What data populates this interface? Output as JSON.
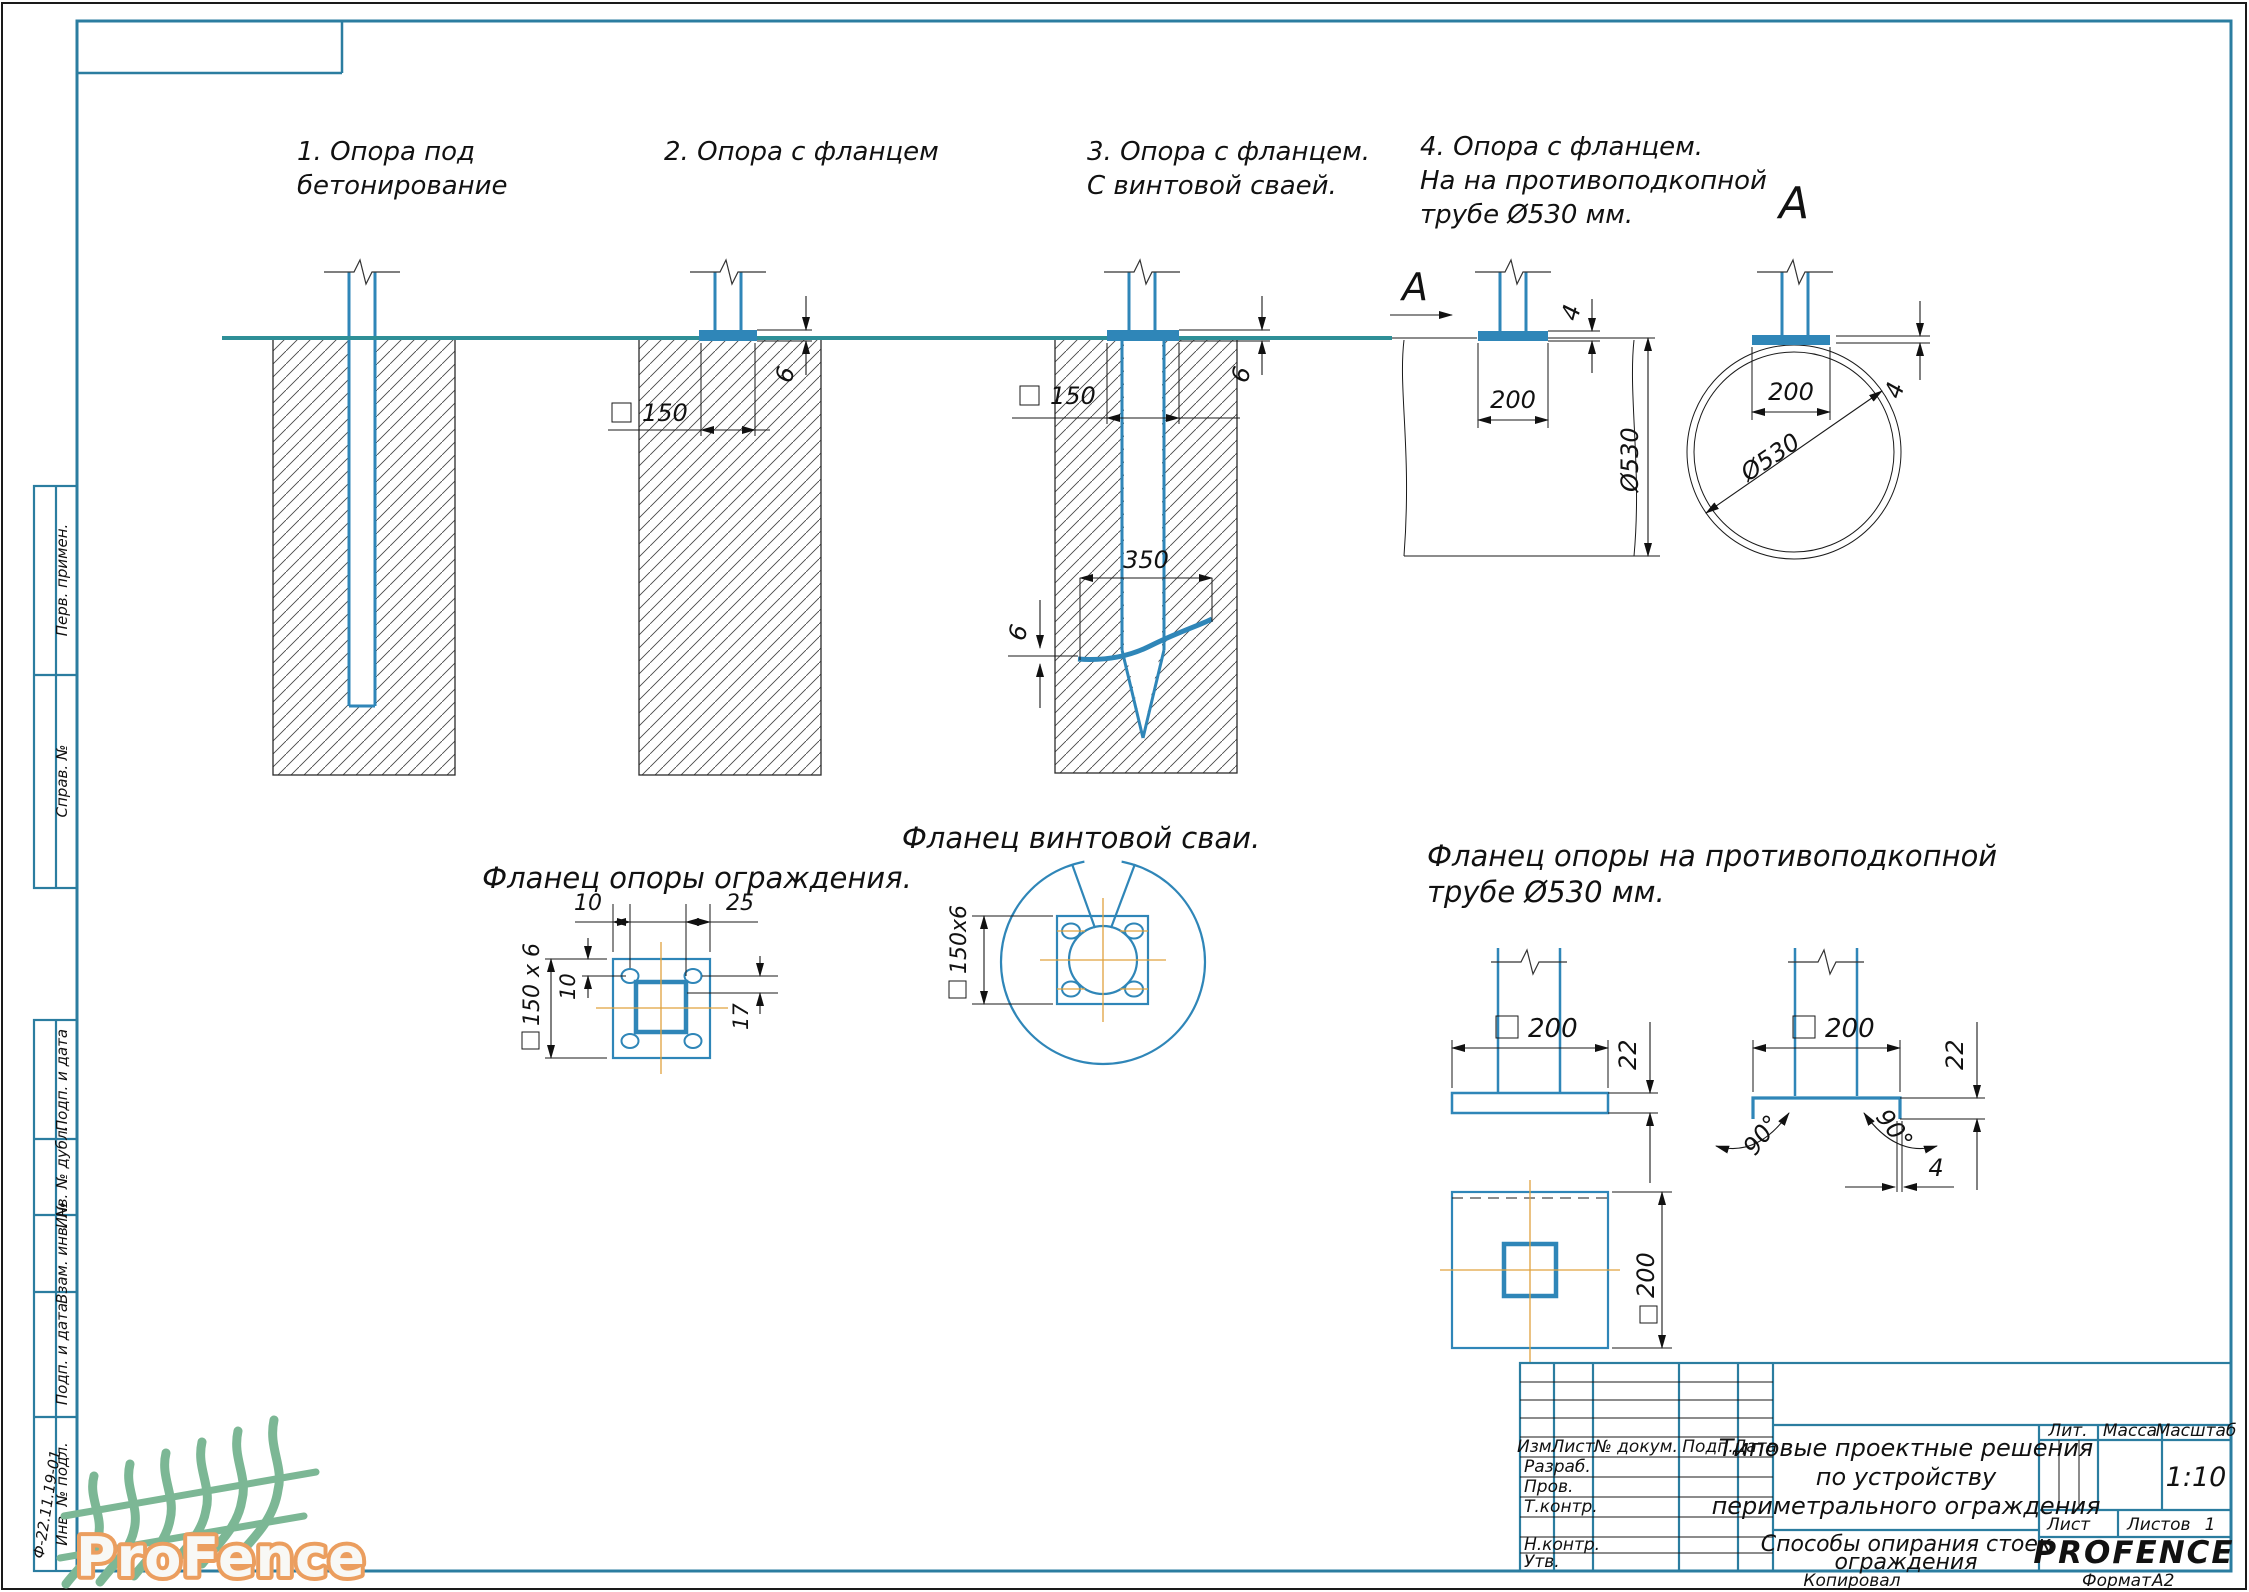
{
  "labels": {
    "o1l1": "1. Опора под",
    "o1l2": "бетонирование",
    "o2": "2. Опора с фланцем",
    "o3l1": "3. Опора с фланцем.",
    "o3l2": "С винтовой сваей.",
    "o4l1": "4. Опора с фланцем.",
    "o4l2": "На на противоподкопной",
    "o4l3": "трубе Ø530 мм.",
    "section_arrow": "A",
    "section_view": "A",
    "f1": "Фланец опоры ограждения.",
    "f2": "Фланец винтовой сваи.",
    "f3l1": "Фланец опоры на противоподкопной",
    "f3l2": "трубе Ø530 мм."
  },
  "dims": {
    "v6": "6",
    "v4": "4",
    "v10": "10",
    "v17": "17",
    "v22": "22",
    "v25": "25",
    "v150": "150",
    "v200": "200",
    "v350": "350",
    "d530": "Ø530",
    "sq150x6": "150 x 6",
    "sq150x6c": "150x6",
    "deg90": "90°"
  },
  "sidebar": {
    "items": [
      "Перв. примен.",
      "Справ. №",
      "Подп. и дата",
      "Инв. № дубл.",
      "Взам. инв. №",
      "Подп. и дата",
      "Инв. № подл."
    ],
    "note": "Ф-22.11.19-01"
  },
  "titleblock": {
    "cols": [
      "Изм.",
      "Лист",
      "№ докум.",
      "Подп.",
      "Дата"
    ],
    "rows": [
      "Разраб.",
      "Пров.",
      "Т.контр.",
      "Н.контр.",
      "Утв."
    ],
    "title_l1": "Типовые проектные решения",
    "title_l2": "по устройству",
    "title_l3": "периметрального ограждения",
    "doc_l1": "Способы опирания стоек",
    "doc_l2": "ограждения",
    "lit": "Лит.",
    "mass": "Масса",
    "scale_label": "Масштаб",
    "scale": "1:10",
    "sheet_label": "Лист",
    "sheets_label": "Листов",
    "sheets_value": "1",
    "brand": "PROFENCE"
  },
  "footer": {
    "kopiroval": "Копировал",
    "format_label": "Формат",
    "format_value": "А2"
  },
  "logo": {
    "text": "ProFence"
  },
  "colors": {
    "frame": "#2b7da0",
    "drawing_blue": "#2f86b8",
    "ground_teal": "#2e8f97",
    "centerline_orange": "#e0a23e",
    "brand_green": "#35d435",
    "logo_fence_green": "#7cb795",
    "logo_text_stroke": "#eb9e5f"
  }
}
